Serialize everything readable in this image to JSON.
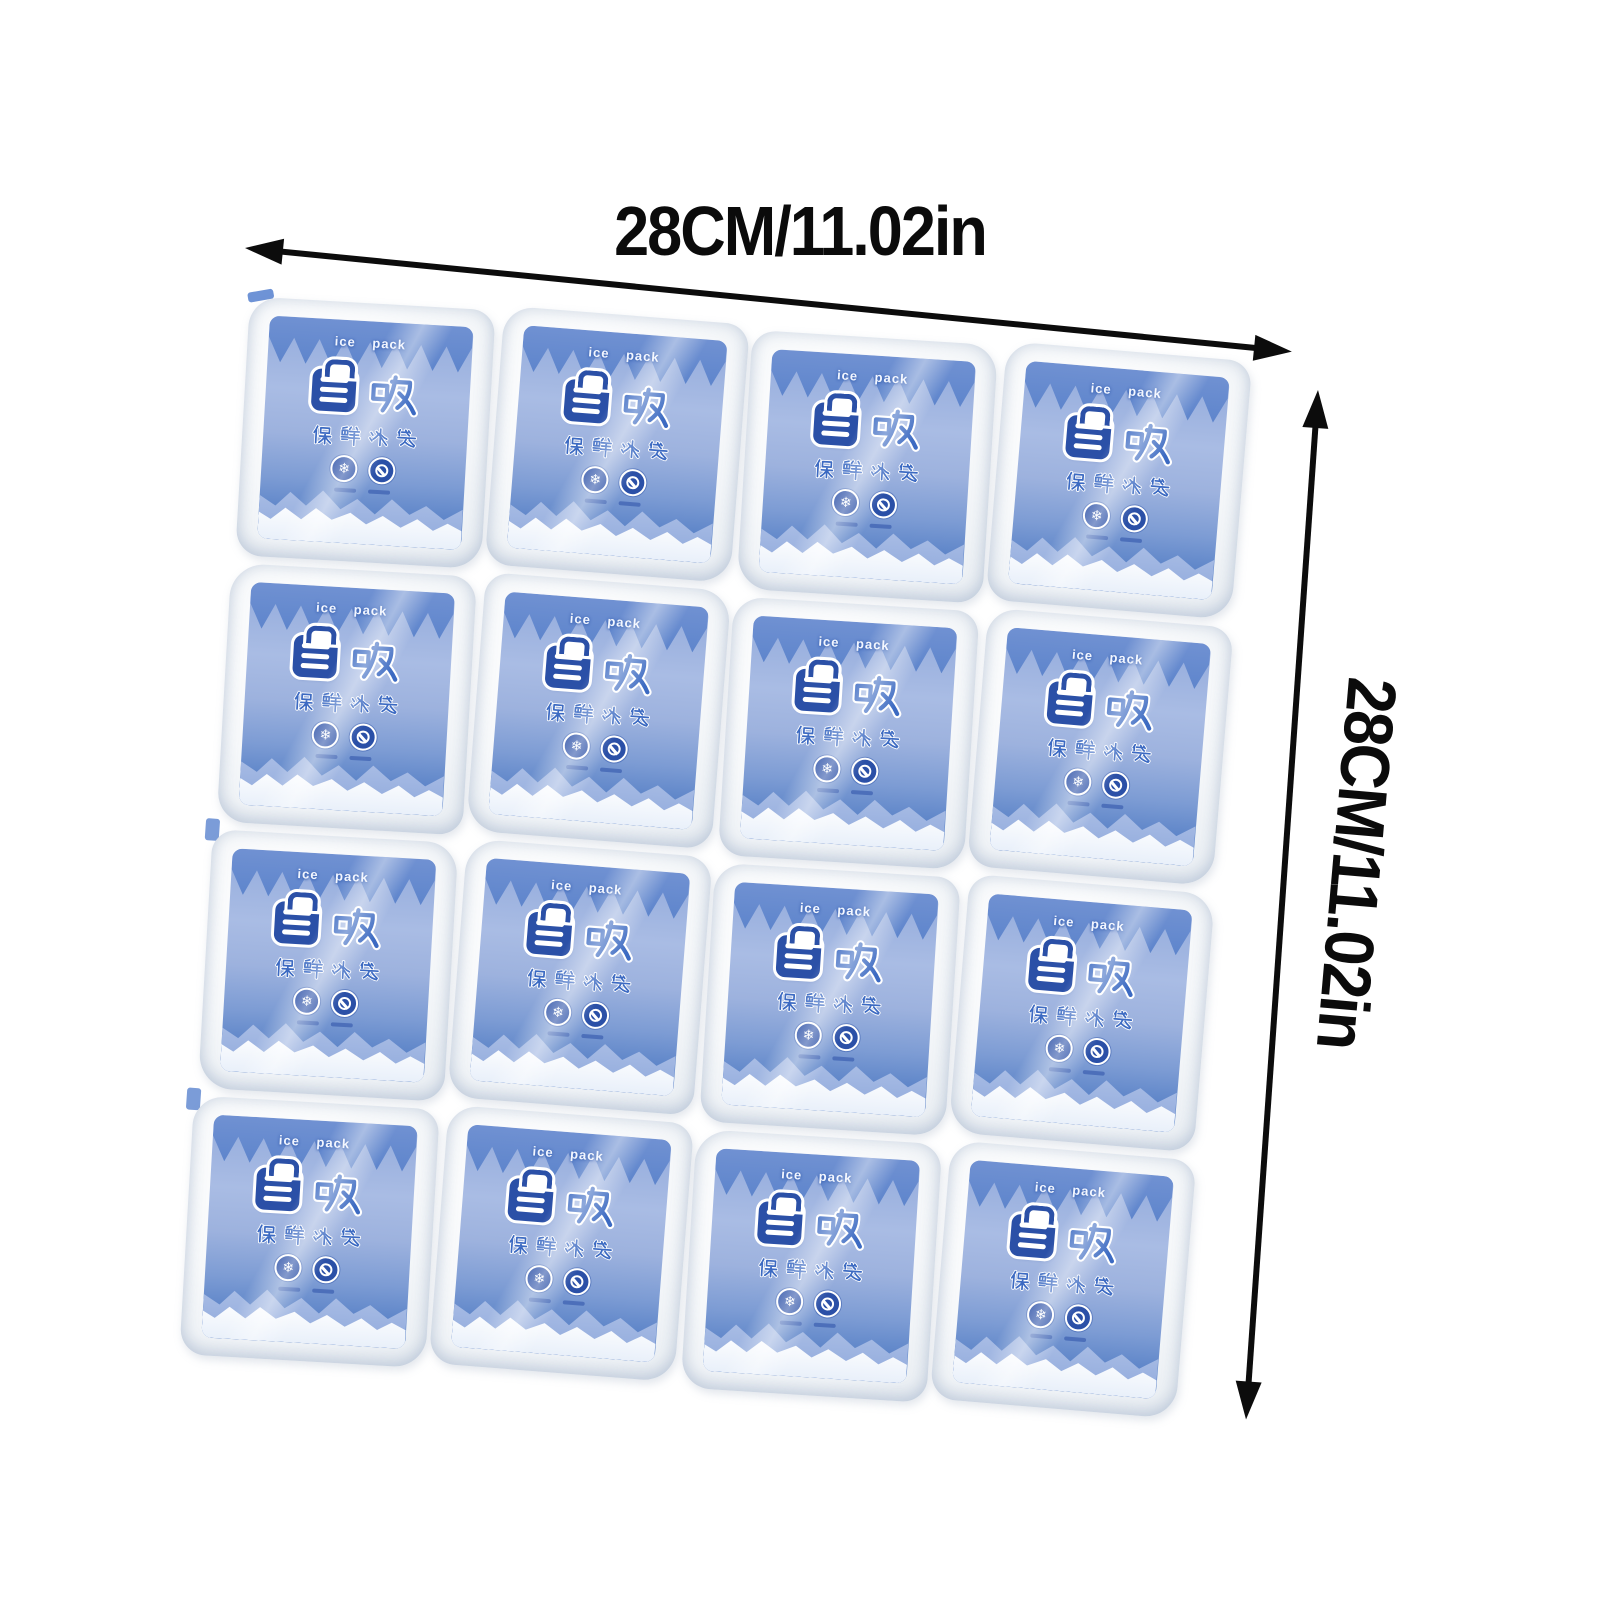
{
  "page": {
    "background": "#ffffff",
    "kind": "product-photo"
  },
  "dimensions": {
    "width_label": "28CM/11.02in",
    "height_label": "28CM/11.02in"
  },
  "ice_pack_sheet": {
    "rows": 4,
    "cols": 4,
    "cells": 16,
    "cell_label": {
      "brand_en": "ice pack",
      "brand_logo_cn": "自吸",
      "product_name_cn": "保鲜冰袋",
      "icons": [
        "snowflake-icon",
        "prohibition-icon"
      ]
    }
  },
  "colors": {
    "arrow_black": "#0c0c0c",
    "logo_deep_blue": "#2b50a7",
    "label_blue": "#3c6ac2",
    "label_sky": "#a9bce4",
    "mountain_white": "#ffffff",
    "pouch_white": "#f6f8fa"
  }
}
